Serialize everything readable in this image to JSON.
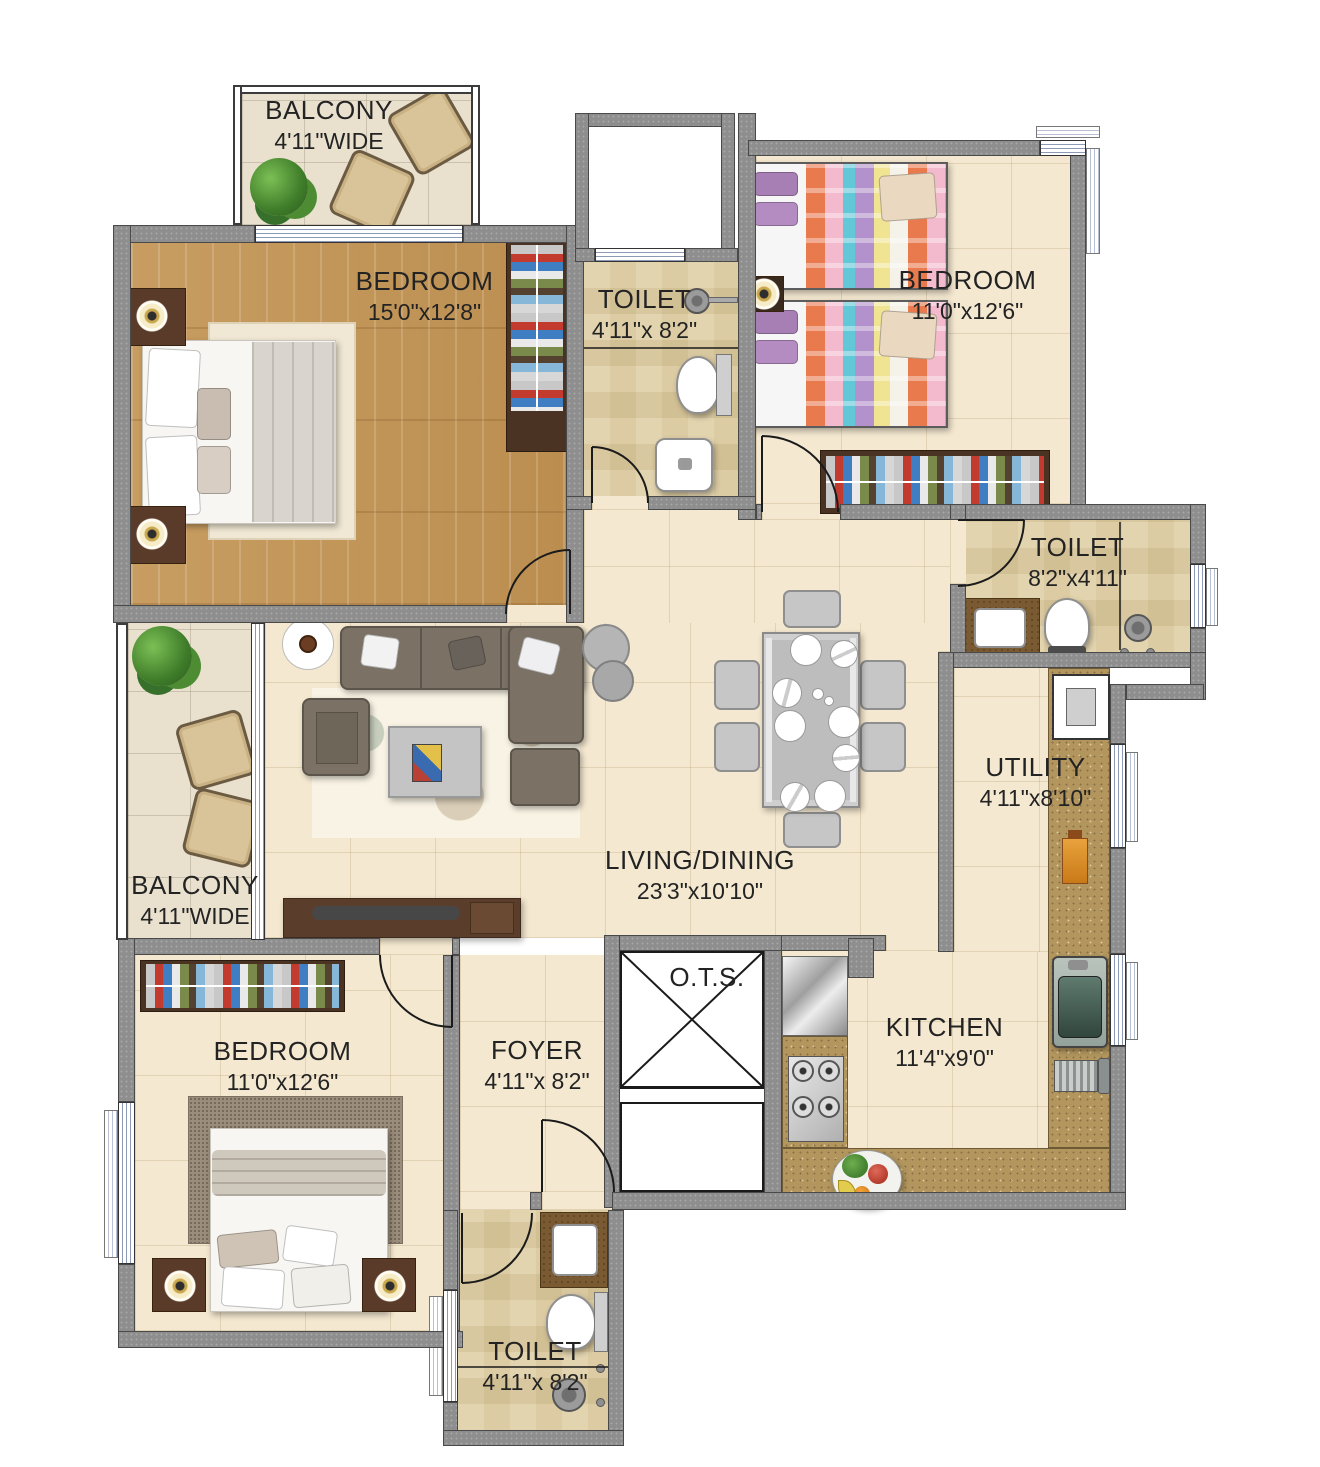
{
  "plan": {
    "type": "apartment-floor-plan",
    "rooms": [
      {
        "id": "balcony-top",
        "label": "BALCONY",
        "dims": "4'11\"WIDE"
      },
      {
        "id": "bedroom-master",
        "label": "BEDROOM",
        "dims": "15'0\"x12'8\""
      },
      {
        "id": "toilet-top",
        "label": "TOILET",
        "dims": "4'11\"x 8'2\""
      },
      {
        "id": "bedroom-right",
        "label": "BEDROOM",
        "dims": "11'0\"x12'6\""
      },
      {
        "id": "toilet-right",
        "label": "TOILET",
        "dims": "8'2\"x4'11\""
      },
      {
        "id": "utility",
        "label": "UTILITY",
        "dims": "4'11\"x8'10\""
      },
      {
        "id": "living-dining",
        "label": "LIVING/DINING",
        "dims": "23'3\"x10'10\""
      },
      {
        "id": "balcony-left",
        "label": "BALCONY",
        "dims": "4'11\"WIDE"
      },
      {
        "id": "bedroom-bottom",
        "label": "BEDROOM",
        "dims": "11'0\"x12'6\""
      },
      {
        "id": "foyer",
        "label": "FOYER",
        "dims": "4'11\"x 8'2\""
      },
      {
        "id": "ots",
        "label": "O.T.S.",
        "dims": ""
      },
      {
        "id": "kitchen",
        "label": "KITCHEN",
        "dims": "11'4\"x9'0\""
      },
      {
        "id": "toilet-bottom",
        "label": "TOILET",
        "dims": "4'11\"x 8'2\""
      }
    ],
    "colors": {
      "wall": "#8e8e8e",
      "wall_edge": "#4a4a4a",
      "floor_beige": "#f4e8d0",
      "floor_wood": "#c59a5e",
      "granite": "#b2965e",
      "wardrobe": "#4a3322",
      "sofa": "#7b7265",
      "window_line": "#8c9ab5",
      "text": "#232323"
    }
  }
}
